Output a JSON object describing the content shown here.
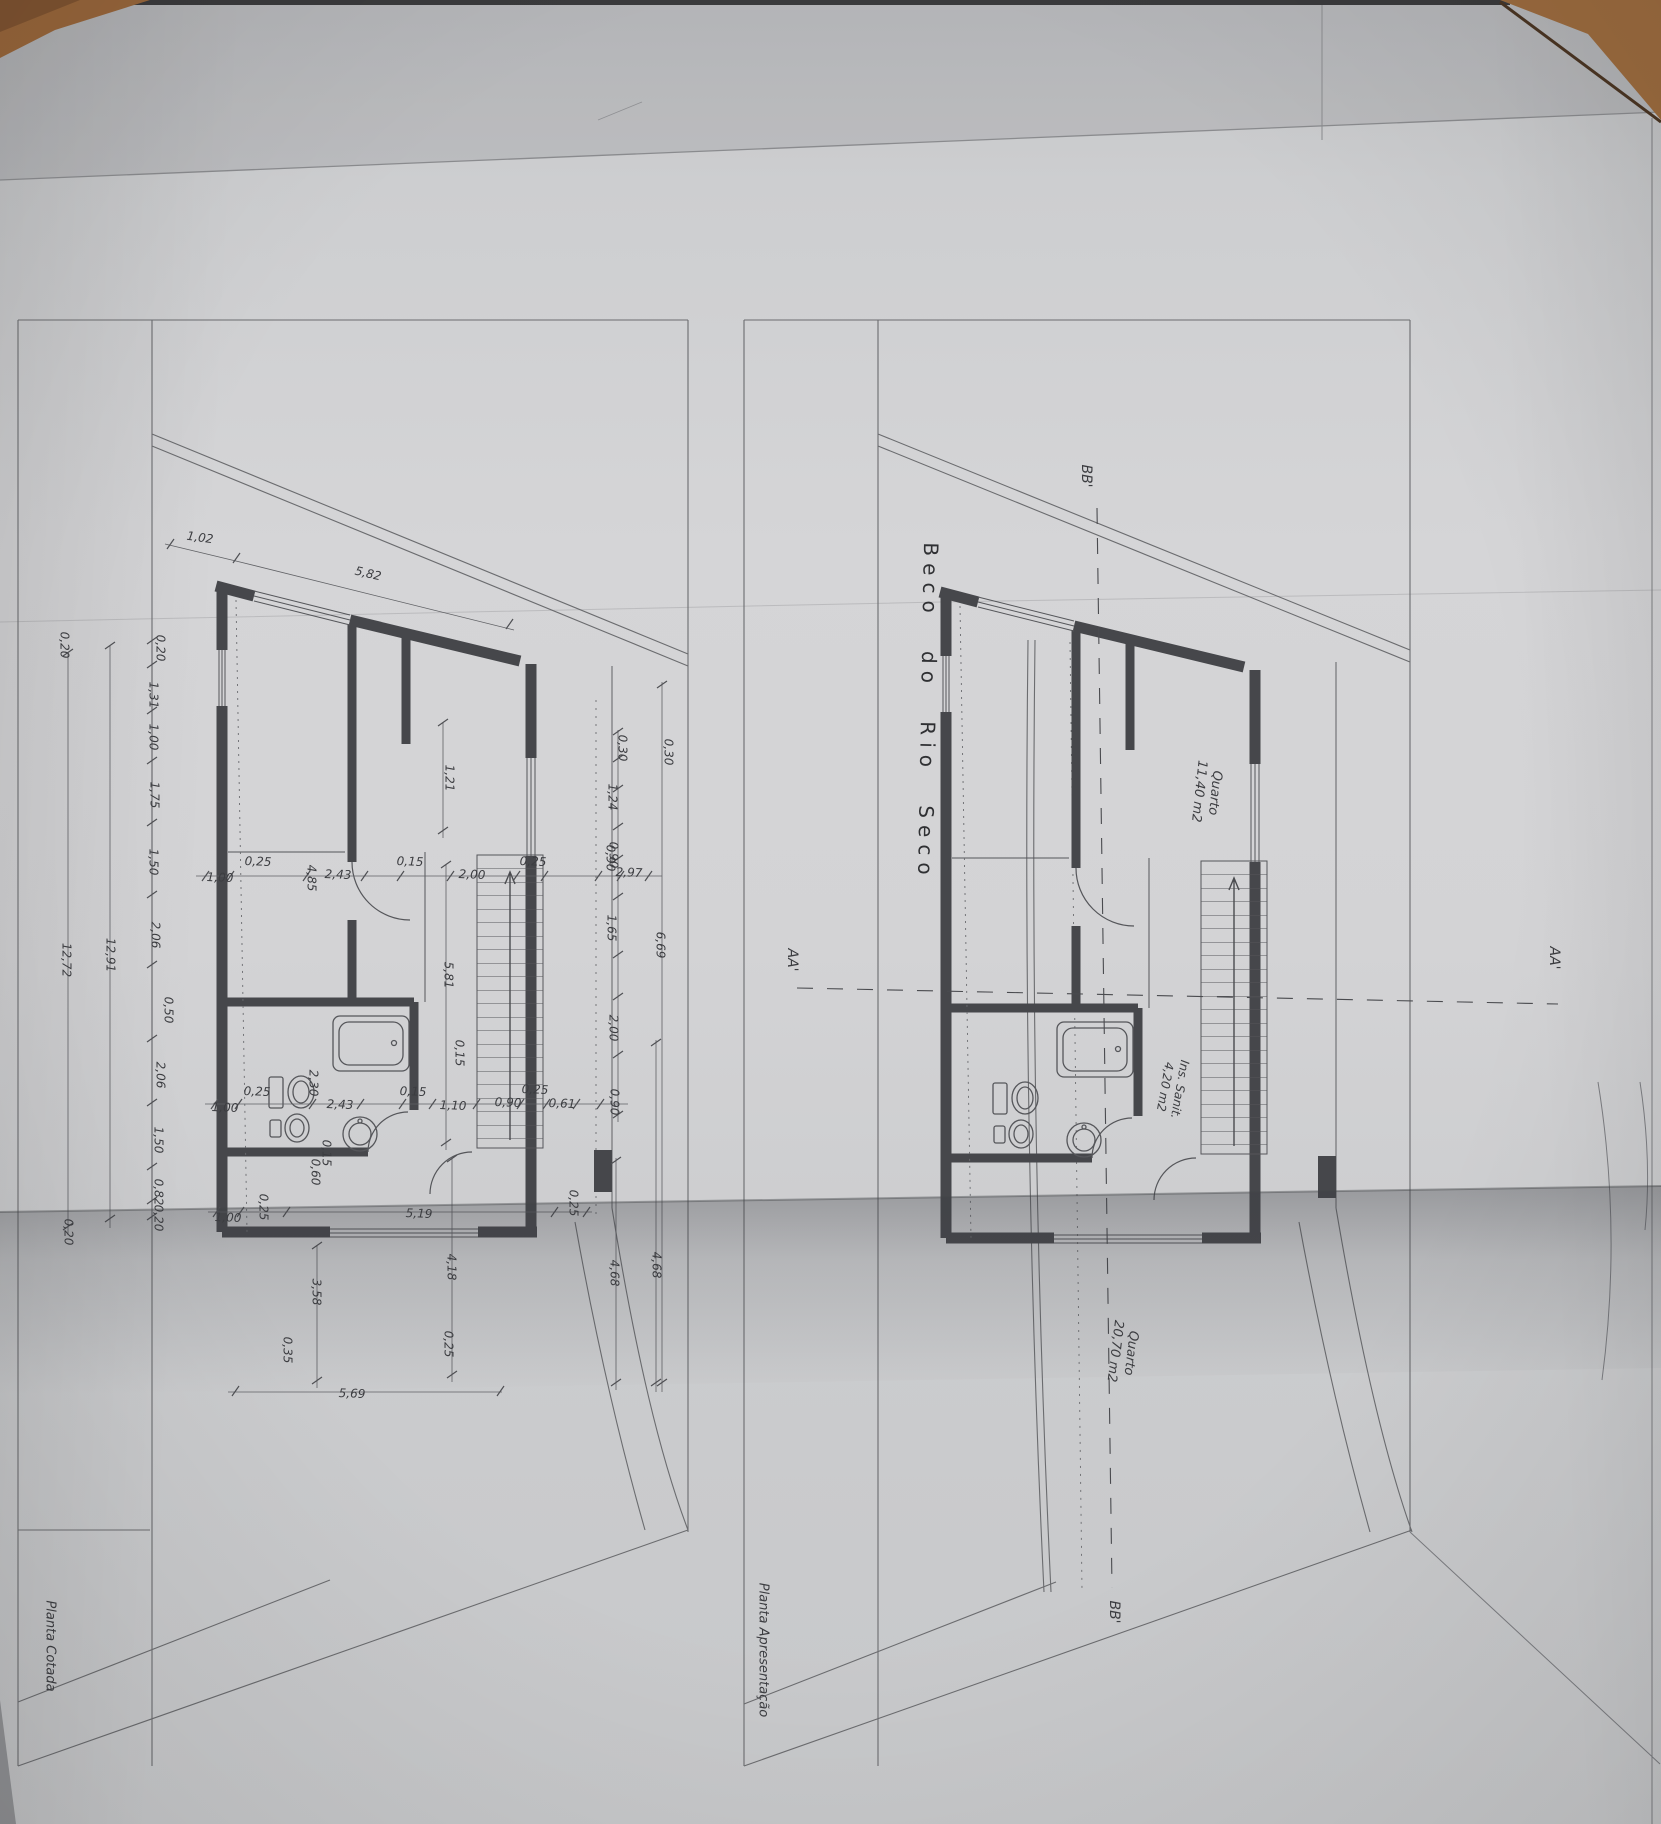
{
  "labels": {
    "street": {
      "t": "Beco do Rio Seco"
    },
    "plan_titles": [
      {
        "t": "Planta Cotada"
      },
      {
        "t": "Planta Apresentação"
      }
    ],
    "sections": [
      {
        "t": "BB'",
        "x": 1085,
        "y": 476,
        "r": 90,
        "fs": 14
      },
      {
        "t": "BB'",
        "x": 1113,
        "y": 1612,
        "r": 90,
        "fs": 14
      },
      {
        "t": "AA'",
        "x": 791,
        "y": 960,
        "r": 90,
        "fs": 14
      },
      {
        "t": "AA'",
        "x": 1553,
        "y": 958,
        "r": 90,
        "fs": 14
      }
    ],
    "rooms": [
      {
        "t": "Quarto\n11,40 m2",
        "x": 1206,
        "y": 792,
        "r": 96,
        "fs": 13
      },
      {
        "t": "Ins. Sanit.\n4,20 m2",
        "x": 1172,
        "y": 1088,
        "r": 100,
        "fs": 12
      },
      {
        "t": "Quarto\n20,70 m2",
        "x": 1122,
        "y": 1352,
        "r": 97,
        "fs": 13
      }
    ],
    "dims": [
      {
        "t": "0,20",
        "x": 160,
        "y": 648
      },
      {
        "t": "1,31",
        "x": 153,
        "y": 695
      },
      {
        "t": "1,00",
        "x": 153,
        "y": 737
      },
      {
        "t": "1,75",
        "x": 154,
        "y": 795
      },
      {
        "t": "1,50",
        "x": 153,
        "y": 862
      },
      {
        "t": "2,06",
        "x": 155,
        "y": 935
      },
      {
        "t": "0,50",
        "x": 168,
        "y": 1010
      },
      {
        "t": "2,06",
        "x": 160,
        "y": 1075
      },
      {
        "t": "1,50",
        "x": 158,
        "y": 1140
      },
      {
        "t": "0,82",
        "x": 158,
        "y": 1192
      },
      {
        "t": "0,20",
        "x": 158,
        "y": 1218
      },
      {
        "t": "12,91",
        "x": 110,
        "y": 955
      },
      {
        "t": "0,20",
        "x": 64,
        "y": 645
      },
      {
        "t": "12,72",
        "x": 66,
        "y": 960
      },
      {
        "t": "0,20",
        "x": 68,
        "y": 1232
      },
      {
        "t": "1,02",
        "x": 200,
        "y": 538,
        "r": 8
      },
      {
        "t": "5,82",
        "x": 368,
        "y": 574,
        "r": 13
      },
      {
        "t": "1,00",
        "x": 220,
        "y": 878,
        "r": 2
      },
      {
        "t": "0,25",
        "x": 258,
        "y": 862,
        "r": 2
      },
      {
        "t": "4,85",
        "x": 311,
        "y": 878
      },
      {
        "t": "2,43",
        "x": 338,
        "y": 875,
        "r": 2
      },
      {
        "t": "0,15",
        "x": 410,
        "y": 862,
        "r": 2
      },
      {
        "t": "2,00",
        "x": 472,
        "y": 875,
        "r": 2
      },
      {
        "t": "0,25",
        "x": 533,
        "y": 862,
        "r": 2
      },
      {
        "t": "0,90",
        "x": 610,
        "y": 858
      },
      {
        "t": "2,97",
        "x": 629,
        "y": 873,
        "r": 2
      },
      {
        "t": "1,21",
        "x": 449,
        "y": 778
      },
      {
        "t": "1,24",
        "x": 612,
        "y": 797
      },
      {
        "t": "0,30",
        "x": 622,
        "y": 748
      },
      {
        "t": "0,30",
        "x": 668,
        "y": 752
      },
      {
        "t": "0,90",
        "x": 613,
        "y": 855
      },
      {
        "t": "1,65",
        "x": 611,
        "y": 928
      },
      {
        "t": "2,00",
        "x": 613,
        "y": 1028
      },
      {
        "t": "0,90",
        "x": 614,
        "y": 1102
      },
      {
        "t": "6,69",
        "x": 660,
        "y": 945
      },
      {
        "t": "5,81",
        "x": 448,
        "y": 975
      },
      {
        "t": "1,00",
        "x": 225,
        "y": 1108,
        "r": 2
      },
      {
        "t": "0,25",
        "x": 257,
        "y": 1092,
        "r": 2
      },
      {
        "t": "2,30",
        "x": 313,
        "y": 1083
      },
      {
        "t": "2,43",
        "x": 340,
        "y": 1105,
        "r": 2
      },
      {
        "t": "0,15",
        "x": 413,
        "y": 1092,
        "r": 2
      },
      {
        "t": "1,10",
        "x": 453,
        "y": 1106,
        "r": 2
      },
      {
        "t": "0,90",
        "x": 508,
        "y": 1103,
        "r": 2
      },
      {
        "t": "0,25",
        "x": 535,
        "y": 1090,
        "r": 2
      },
      {
        "t": "0,61",
        "x": 562,
        "y": 1104,
        "r": 2
      },
      {
        "t": "0,15",
        "x": 459,
        "y": 1053
      },
      {
        "t": "0,60",
        "x": 315,
        "y": 1172
      },
      {
        "t": "0,15",
        "x": 326,
        "y": 1153
      },
      {
        "t": "1,00",
        "x": 228,
        "y": 1218,
        "r": 2
      },
      {
        "t": "0,25",
        "x": 263,
        "y": 1207
      },
      {
        "t": "5,19",
        "x": 419,
        "y": 1214,
        "r": 2
      },
      {
        "t": "0,25",
        "x": 573,
        "y": 1203
      },
      {
        "t": "4,18",
        "x": 451,
        "y": 1267
      },
      {
        "t": "3,58",
        "x": 316,
        "y": 1292
      },
      {
        "t": "4,68",
        "x": 614,
        "y": 1273
      },
      {
        "t": "4,68",
        "x": 656,
        "y": 1265
      },
      {
        "t": "5,69",
        "x": 352,
        "y": 1394,
        "r": 2
      },
      {
        "t": "0,35",
        "x": 287,
        "y": 1350
      },
      {
        "t": "0,25",
        "x": 448,
        "y": 1344
      }
    ]
  }
}
